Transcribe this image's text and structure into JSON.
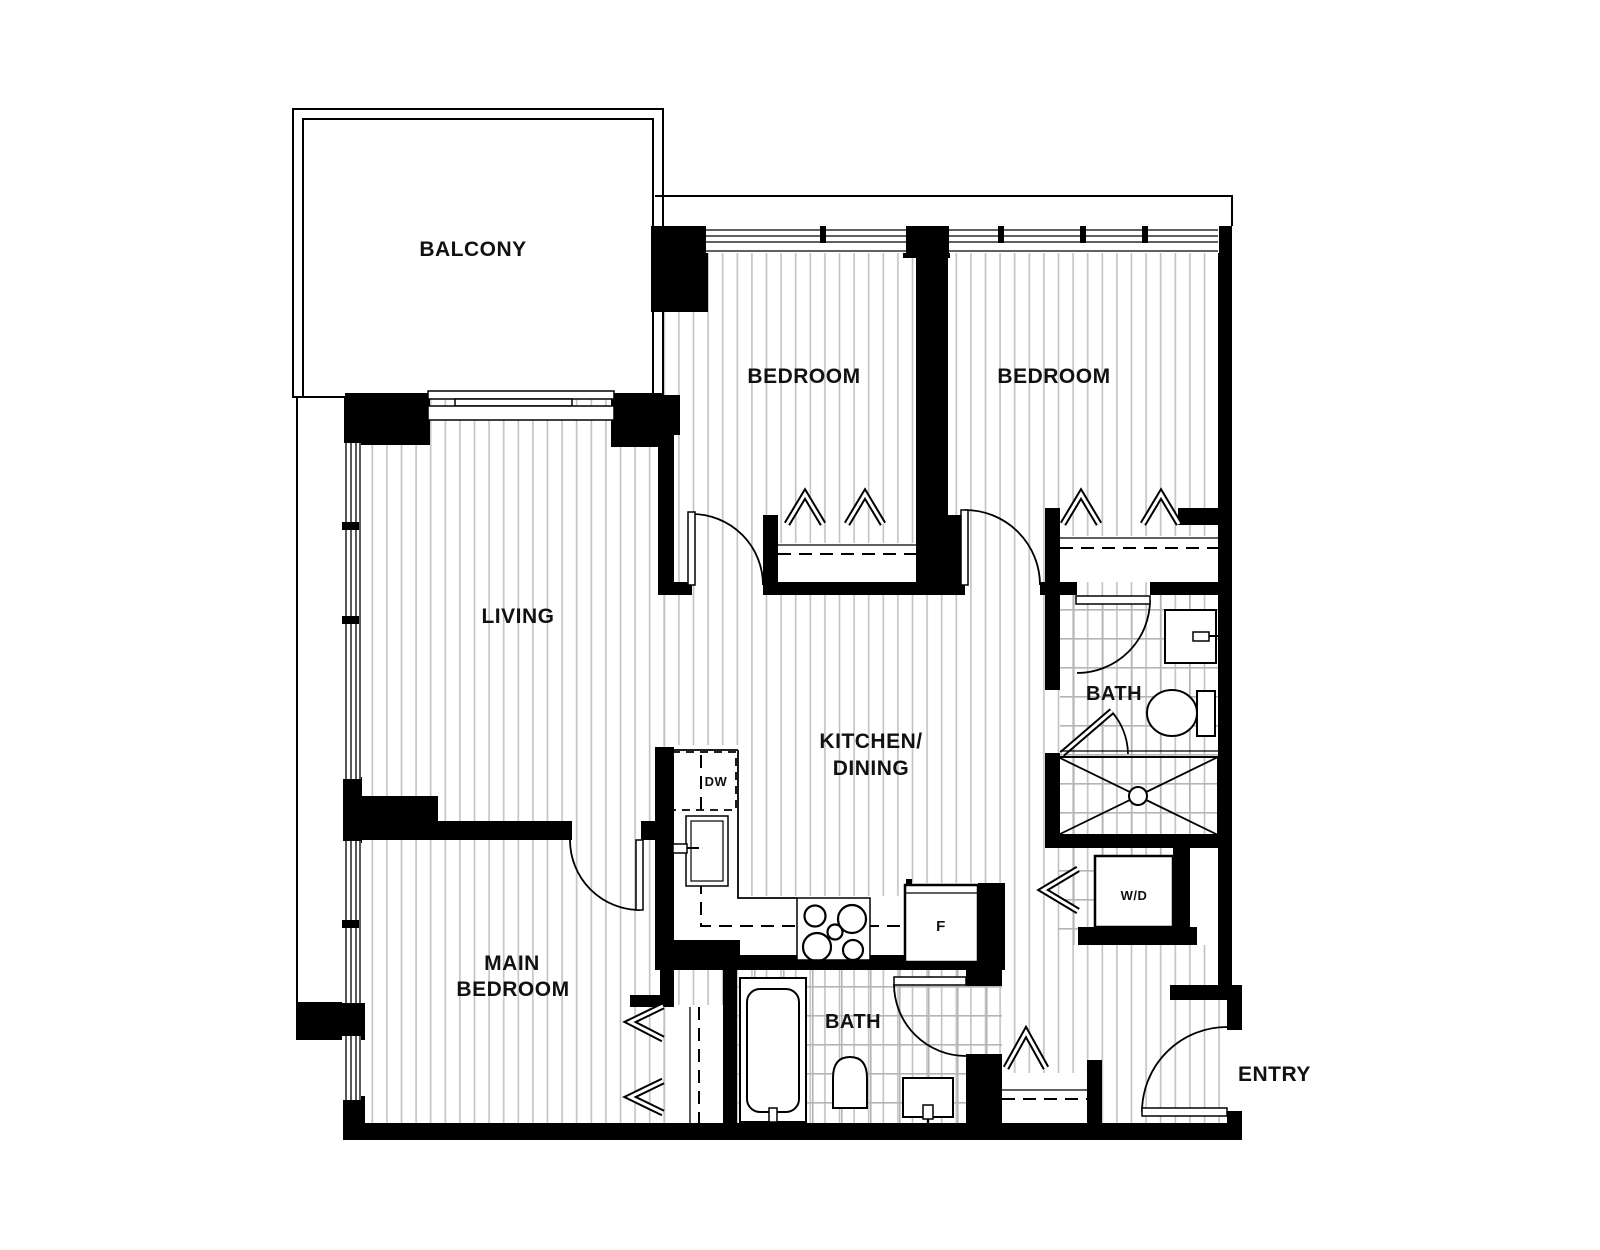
{
  "floorplan": {
    "rooms": {
      "balcony": {
        "label": "BALCONY"
      },
      "bedroom_top_left": {
        "label": "BEDROOM"
      },
      "bedroom_top_right": {
        "label": "BEDROOM"
      },
      "living": {
        "label": "LIVING"
      },
      "kitchen_dining": {
        "label_line1": "KITCHEN/",
        "label_line2": "DINING"
      },
      "bath_upper": {
        "label": "BATH"
      },
      "bath_lower": {
        "label": "BATH"
      },
      "main_bedroom": {
        "label_line1": "MAIN",
        "label_line2": "BEDROOM"
      },
      "entry": {
        "label": "ENTRY"
      }
    },
    "appliances": {
      "washer_dryer": {
        "label": "W/D"
      },
      "dishwasher": {
        "label": "DW"
      },
      "fridge": {
        "label": "F"
      }
    },
    "colors": {
      "background": "#ffffff",
      "wall": "#000000",
      "floor_hatch": "#c2c2c2",
      "tile_grid": "#b5b5b5",
      "text": "#111111"
    }
  }
}
